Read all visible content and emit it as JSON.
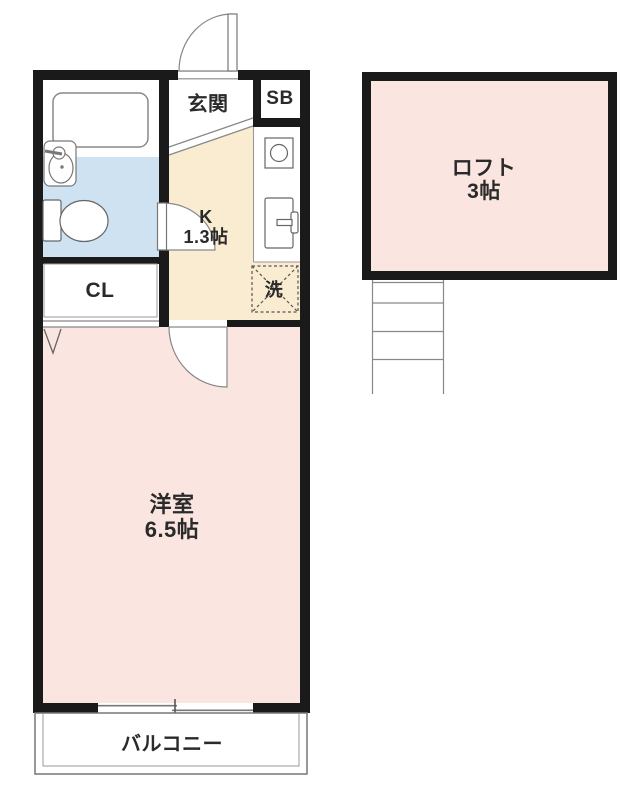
{
  "plan": {
    "rooms": {
      "genkan": {
        "label": "玄関"
      },
      "shoebox": {
        "label": "SB"
      },
      "kitchen": {
        "label": "K",
        "size": "1.3帖"
      },
      "closet": {
        "label": "CL"
      },
      "washer": {
        "label": "洗"
      },
      "western_room": {
        "label": "洋室",
        "size": "6.5帖"
      },
      "balcony": {
        "label": "バルコニー"
      },
      "loft": {
        "label": "ロフト",
        "size": "3帖"
      }
    },
    "colors": {
      "wall": "#1a1a1a",
      "room_pink": "#fbe5e0",
      "kitchen_beige": "#faecd1",
      "bath_blue": "#cfe2f2",
      "line_gray": "#777777"
    }
  }
}
